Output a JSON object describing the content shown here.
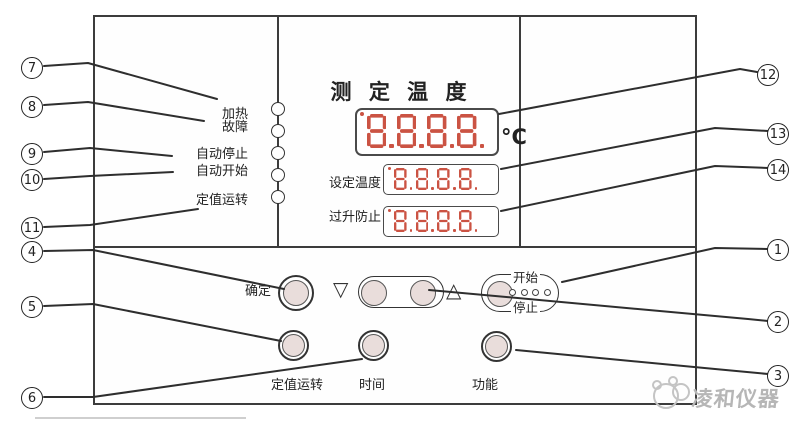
{
  "colors": {
    "digit": "#cb5343",
    "line": "#2e2e2e",
    "button_fill": "#e9dddb",
    "panel_border": "#3c3c3c",
    "watermark": "#b6b6b6"
  },
  "panel": {
    "title": "测 定 温 度",
    "unit": "°C",
    "indicators": [
      {
        "label": "加热"
      },
      {
        "label": "故障"
      },
      {
        "label": "自动停止"
      },
      {
        "label": "自动开始"
      },
      {
        "label": "定值运转"
      }
    ],
    "displays": {
      "measured": {
        "value": "8.8.8.8."
      },
      "set": {
        "label": "设定温度",
        "value": "8.8.8.8."
      },
      "overheat": {
        "label": "过升防止",
        "value": "8.8.8.8."
      }
    },
    "controls": {
      "confirm": "确定",
      "down": "▽",
      "up": "△",
      "start": "开始",
      "stop": "停止",
      "fixed_run": "定值运转",
      "time": "时间",
      "function": "功能"
    }
  },
  "callouts": {
    "left": [
      {
        "n": "7"
      },
      {
        "n": "8"
      },
      {
        "n": "9"
      },
      {
        "n": "10"
      },
      {
        "n": "11"
      },
      {
        "n": "4"
      },
      {
        "n": "5"
      },
      {
        "n": "6"
      }
    ],
    "right": [
      {
        "n": "12"
      },
      {
        "n": "13"
      },
      {
        "n": "14"
      },
      {
        "n": "1"
      },
      {
        "n": "2"
      },
      {
        "n": "3"
      }
    ]
  },
  "watermark": {
    "text": "凌和仪器"
  }
}
